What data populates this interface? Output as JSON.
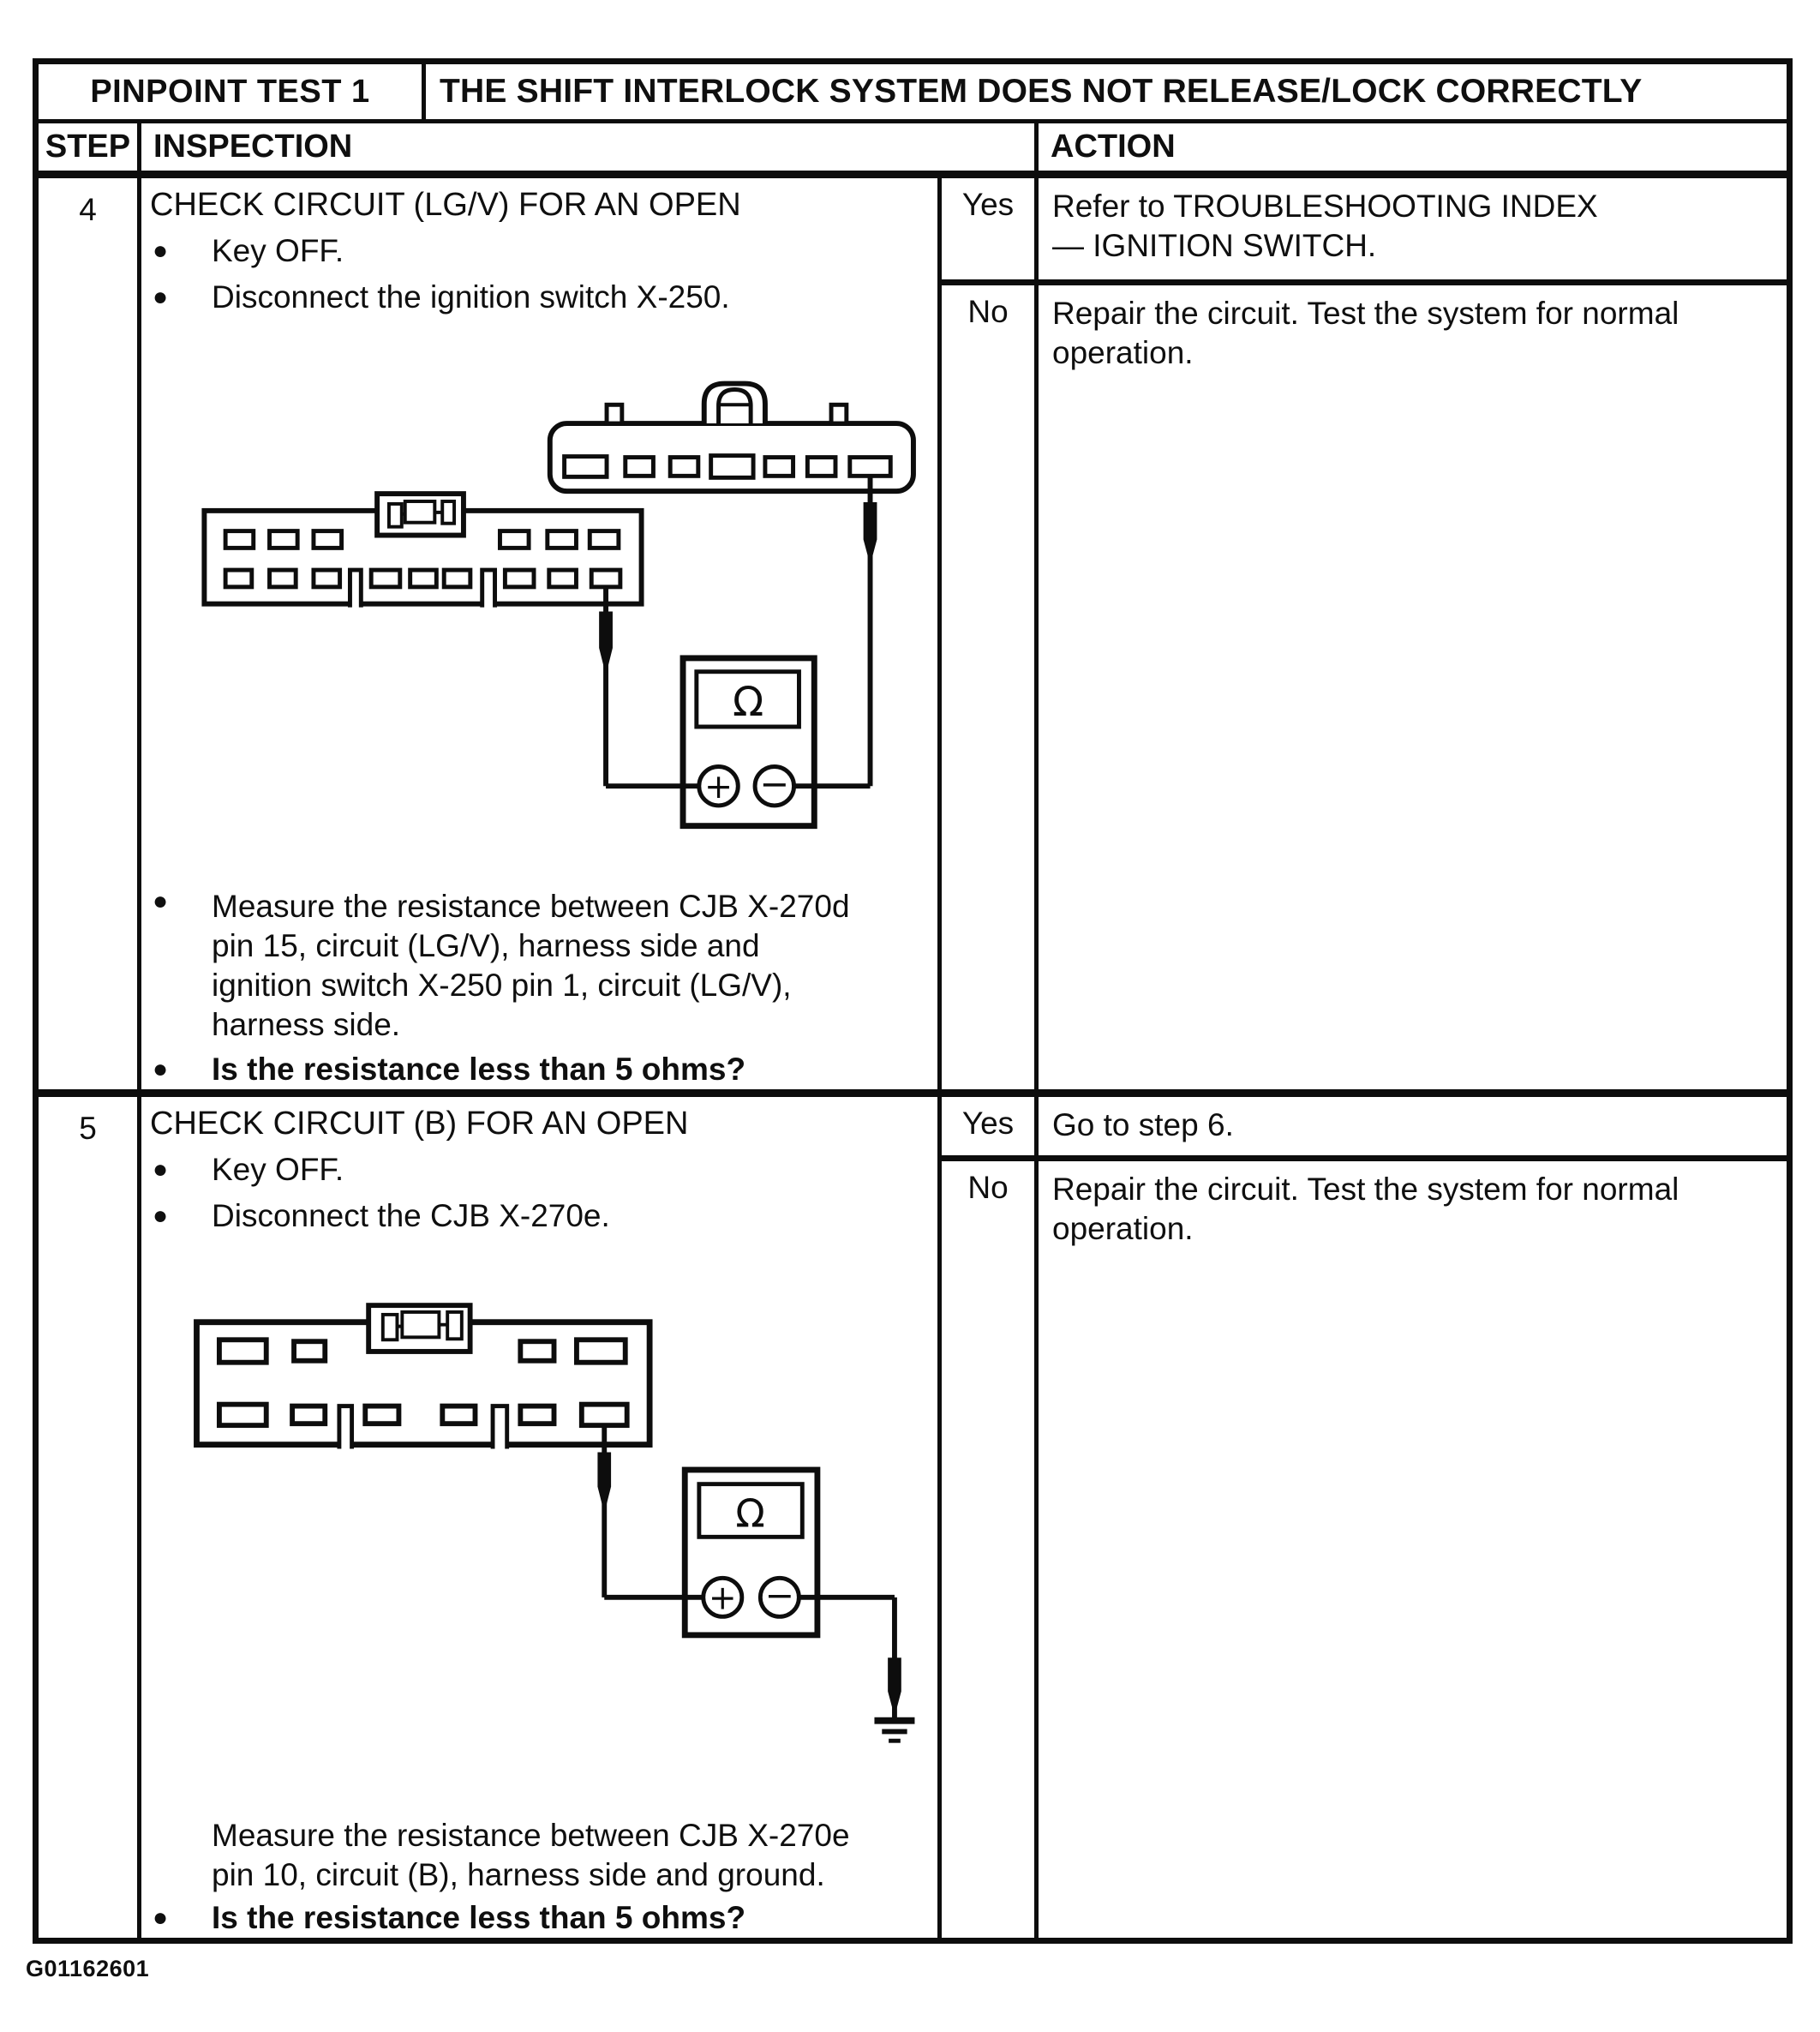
{
  "page": {
    "footer_id": "G01162601"
  },
  "table": {
    "title_cell": "PINPOINT TEST 1",
    "title_text": "THE SHIFT INTERLOCK SYSTEM DOES NOT RELEASE/LOCK CORRECTLY",
    "columns": {
      "step": "STEP",
      "inspection": "INSPECTION",
      "action": "ACTION"
    }
  },
  "rows": [
    {
      "step": "4",
      "title": "CHECK CIRCUIT (LG/V) FOR AN OPEN",
      "bullets": [
        "Key OFF.",
        "Disconnect the ignition switch X-250."
      ],
      "measure": [
        "Measure the resistance between CJB X-270d",
        "pin 15, circuit (LG/V), harness side and",
        "ignition switch X-250 pin 1, circuit (LG/V),",
        "harness side."
      ],
      "question": "Is the resistance less than 5 ohms?",
      "yes_label": "Yes",
      "yes_lines": [
        "Refer to TROUBLESHOOTING INDEX",
        "— IGNITION SWITCH."
      ],
      "no_label": "No",
      "no_lines": [
        "Repair the circuit.  Test the system for normal",
        "operation."
      ]
    },
    {
      "step": "5",
      "title": "CHECK CIRCUIT (B) FOR AN OPEN",
      "bullets": [
        "Key OFF.",
        "Disconnect the CJB X-270e."
      ],
      "measure": [
        "Measure the resistance between CJB X-270e",
        "pin 10, circuit (B), harness side and ground."
      ],
      "question": "Is the resistance less than 5 ohms?",
      "yes_label": "Yes",
      "yes_lines": [
        "Go to step 6."
      ],
      "no_label": "No",
      "no_lines": [
        "Repair the circuit.  Test the system for normal",
        "operation."
      ]
    }
  ],
  "meter": {
    "display_symbol": "Ω",
    "plus_label": "+",
    "minus_label": "−"
  }
}
